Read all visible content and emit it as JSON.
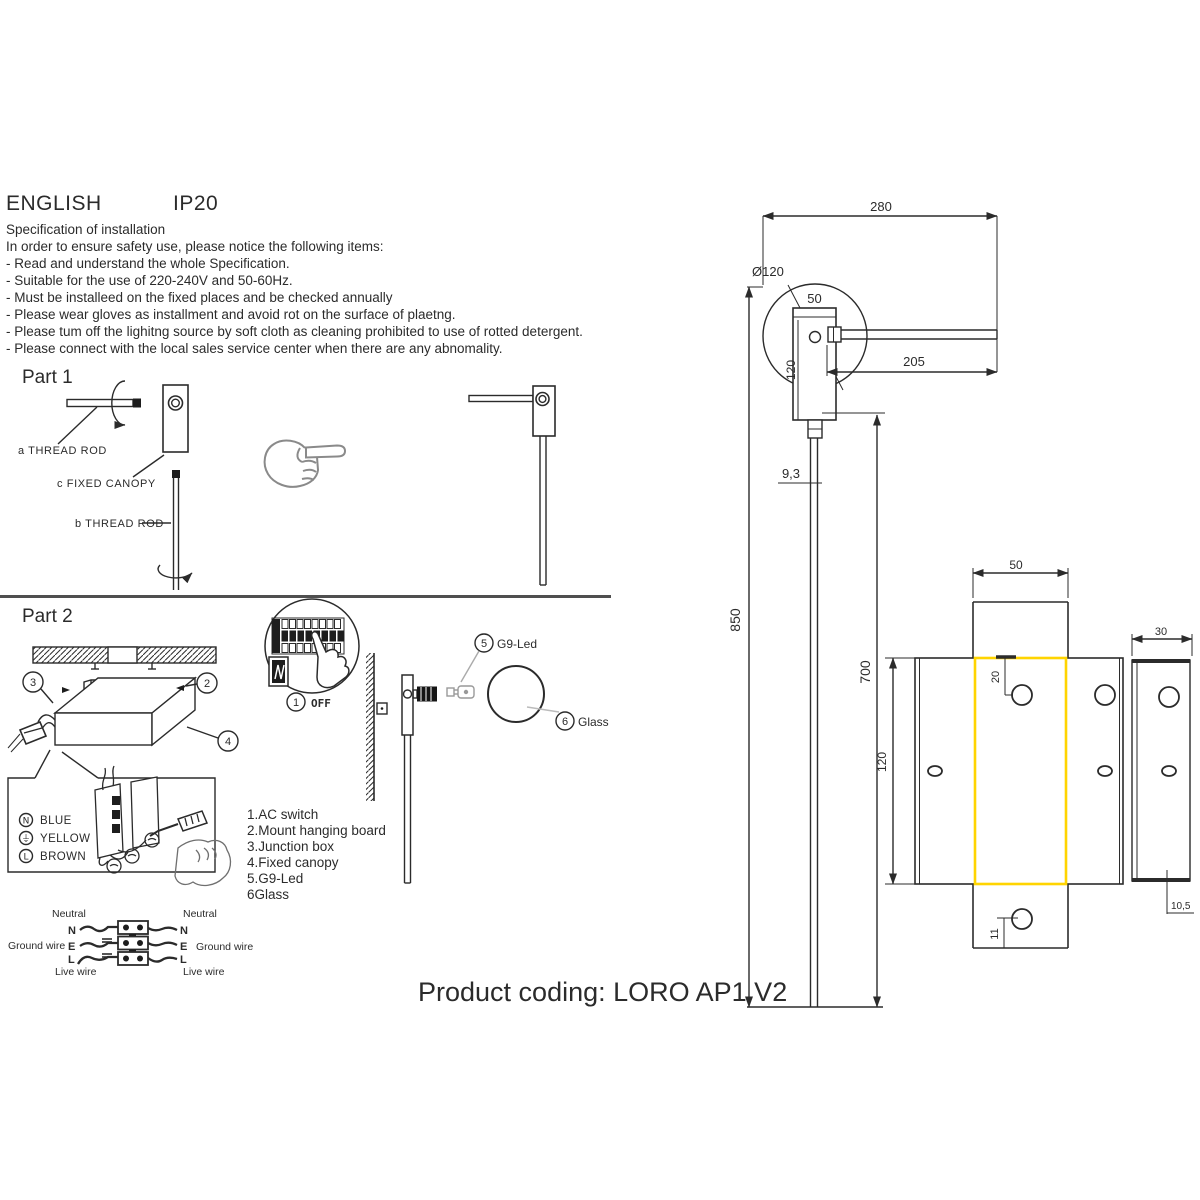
{
  "header": {
    "language": "ENGLISH",
    "ip_rating": "IP20"
  },
  "spec": {
    "title": "Specification of installation",
    "intro": "In order to ensure safety use, please notice the following items:",
    "items": [
      "- Read and understand the whole Specification.",
      "- Suitable for the use of 220-240V and 50-60Hz.",
      "- Must be installeed on the fixed places and be checked annually",
      "- Please wear gloves as installment and avoid rot on the surface of plaetng.",
      "- Please tum off the lighitng source by soft cloth as cleaning prohibited to use of rotted detergent.",
      "- Please connect with the local sales service center when there are any abnomality."
    ]
  },
  "part1": {
    "title": "Part 1",
    "label_a": "a THREAD ROD",
    "label_c": "c FIXED CANOPY",
    "label_b": "b THREAD ROD"
  },
  "part2": {
    "title": "Part 2",
    "callouts": {
      "n1": "1",
      "n2": "2",
      "n3": "3",
      "n4": "4",
      "n5": "5",
      "n6": "6"
    },
    "off_label": "OFF",
    "g9_label": "G9-Led",
    "glass_label": "Glass",
    "legend": [
      {
        "symbol": "N",
        "color_name": "BLUE"
      },
      {
        "symbol": "⏚",
        "color_name": "YELLOW"
      },
      {
        "symbol": "L",
        "color_name": "BROWN"
      }
    ],
    "steps": [
      "1.AC switch",
      "2.Mount hanging board",
      "3.Junction box",
      "4.Fixed canopy",
      "5.G9-Led",
      "6Glass"
    ],
    "wiring": {
      "left": {
        "neutral": "Neutral",
        "n": "N",
        "e": "E",
        "l": "L",
        "ground": "Ground wire",
        "live": "Live wire"
      },
      "right": {
        "neutral": "Neutral",
        "n": "N",
        "e": "E",
        "l": "L",
        "ground": "Ground wire",
        "live": "Live wire"
      }
    }
  },
  "drawing": {
    "dim_total_width": "280",
    "dim_diameter": "Ø120",
    "dim_canopy_width": "50",
    "dim_arm_length": "205",
    "dim_canopy_height": "120",
    "dim_rod_width": "9,3",
    "dim_total_height": "850",
    "dim_rod_length": "700",
    "dim_bracket_width": "50",
    "dim_bracket_height": "120",
    "dim_hole_offset_top": "20",
    "dim_hole_offset_bottom": "11",
    "dim_side_width": "30",
    "dim_side_depth": "10,5",
    "highlight_color": "#FFD400"
  },
  "footer": {
    "product_coding": "Product coding: LORO AP1 V2"
  }
}
